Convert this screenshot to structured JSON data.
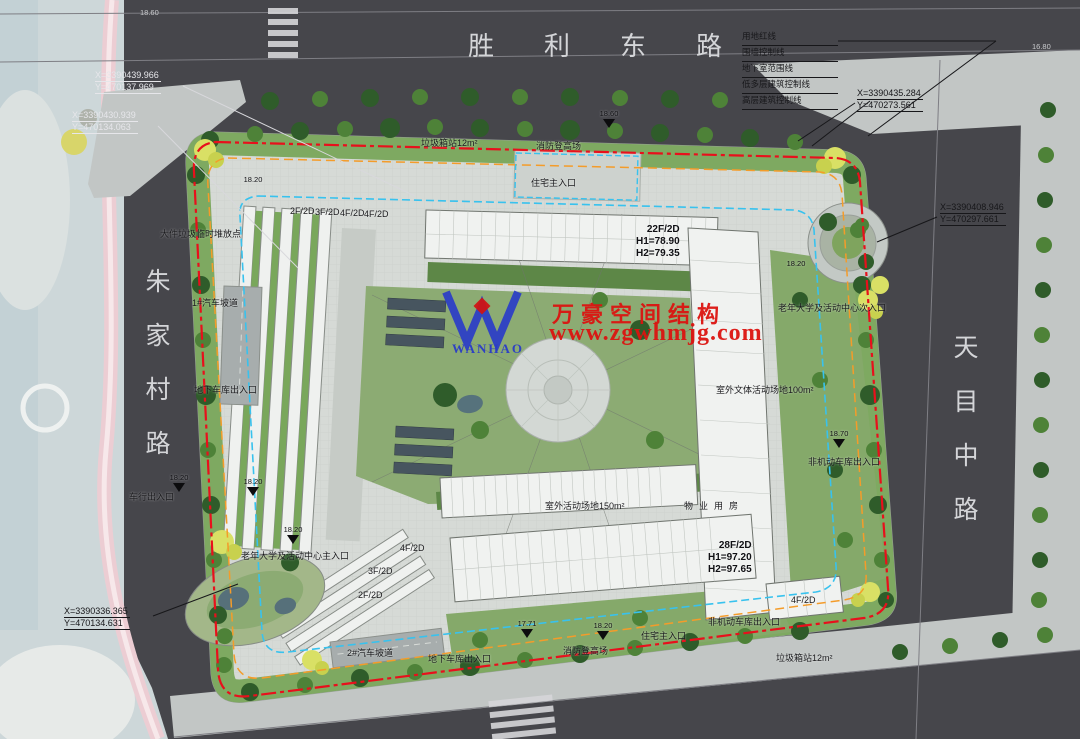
{
  "roads": {
    "top": "胜利东路",
    "left": "朱家村路",
    "right": "天目中路"
  },
  "legend": {
    "items": [
      "用地红线",
      "围墙控制线",
      "地下室范围线",
      "低多层建筑控制线",
      "高层建筑控制线"
    ]
  },
  "coordinates": [
    {
      "id": "top-left-outer",
      "x_label": "X=3390439.966",
      "y_label": "Y=470137.969"
    },
    {
      "id": "top-left-inner",
      "x_label": "X=3390430.939",
      "y_label": "Y=470134.063"
    },
    {
      "id": "top-right",
      "x_label": "X=3390435.284",
      "y_label": "Y=470273.561"
    },
    {
      "id": "right",
      "x_label": "X=3390408.946",
      "y_label": "Y=470297.661"
    },
    {
      "id": "bottom-left",
      "x_label": "X=3390336.365",
      "y_label": "Y=470134.631"
    }
  ],
  "buildings": [
    {
      "id": "north-tower",
      "floors": "22F/2D",
      "h1": "H1=78.90",
      "h2": "H2=79.35"
    },
    {
      "id": "south-tower",
      "floors": "28F/2D",
      "h1": "H1=97.20",
      "h2": "H2=97.65"
    }
  ],
  "watermark": {
    "company": "万豪空间结构",
    "website": "www.zgwhmjg.com",
    "logo_text": "WANHAO"
  },
  "annotations": [
    {
      "t": "垃圾箱站12m²",
      "x": 421,
      "y": 138
    },
    {
      "t": "消防登高场",
      "x": 536,
      "y": 141
    },
    {
      "t": "住宅主入口",
      "x": 531,
      "y": 178
    },
    {
      "t": "大件垃圾临时堆放点",
      "x": 160,
      "y": 229
    },
    {
      "t": "1#汽车坡道",
      "x": 192,
      "y": 298
    },
    {
      "t": "地下车库出入口",
      "x": 194,
      "y": 385
    },
    {
      "t": "车行出入口",
      "x": 129,
      "y": 492
    },
    {
      "t": "老年大学及活动中心次入口",
      "x": 778,
      "y": 303
    },
    {
      "t": "室外文体活动场地100m²",
      "x": 716,
      "y": 385
    },
    {
      "t": "非机动车库出入口",
      "x": 808,
      "y": 457
    },
    {
      "t": "室外活动场地150m²",
      "x": 545,
      "y": 501
    },
    {
      "t": "物业用房",
      "x": 684,
      "y": 501,
      "cls": "spaced"
    },
    {
      "t": "老年大学及活动中心主入口",
      "x": 241,
      "y": 551
    },
    {
      "t": "2#汽车坡道",
      "x": 347,
      "y": 648
    },
    {
      "t": "地下车库出入口",
      "x": 428,
      "y": 654
    },
    {
      "t": "消防登高场",
      "x": 563,
      "y": 646
    },
    {
      "t": "住宅主入口",
      "x": 641,
      "y": 631
    },
    {
      "t": "非机动车库出入口",
      "x": 708,
      "y": 617
    },
    {
      "t": "垃圾箱站12m²",
      "x": 776,
      "y": 653
    },
    {
      "t": "2F/2D",
      "x": 290,
      "y": 206
    },
    {
      "t": "3F/2D",
      "x": 315,
      "y": 207
    },
    {
      "t": "4F/2D",
      "x": 340,
      "y": 208
    },
    {
      "t": "4F/2D",
      "x": 364,
      "y": 209
    },
    {
      "t": "4F/2D",
      "x": 400,
      "y": 543
    },
    {
      "t": "3F/2D",
      "x": 368,
      "y": 566
    },
    {
      "t": "2F/2D",
      "x": 358,
      "y": 590
    },
    {
      "t": "4F/2D",
      "x": 791,
      "y": 595
    }
  ],
  "elevation_markers": [
    {
      "v": "18.60",
      "x": 594,
      "y": 110,
      "tri": true
    },
    {
      "v": "18.20",
      "x": 238,
      "y": 176,
      "tri": false
    },
    {
      "v": "18.20",
      "x": 781,
      "y": 260,
      "tri": false
    },
    {
      "v": "18.70",
      "x": 824,
      "y": 430,
      "tri": true
    },
    {
      "v": "18.20",
      "x": 164,
      "y": 474,
      "tri": true
    },
    {
      "v": "18.20",
      "x": 238,
      "y": 478,
      "tri": true
    },
    {
      "v": "18.20",
      "x": 278,
      "y": 526,
      "tri": true
    },
    {
      "v": "17.71",
      "x": 512,
      "y": 620,
      "tri": true
    },
    {
      "v": "18.20",
      "x": 588,
      "y": 622,
      "tri": true
    }
  ],
  "station_markers": [
    {
      "v": "18.60",
      "x": 140,
      "y": 8
    },
    {
      "v": "16.80",
      "x": 1032,
      "y": 42
    }
  ],
  "colors": {
    "boundary_red": "#e8101c",
    "control_orange": "#f49c2a",
    "basement_cyan": "#38c2ee",
    "watermark_red": "#dc1410",
    "logo_blue": "#2a3cc8",
    "road_dark": "#46464b",
    "greenery": "#79a75b"
  }
}
